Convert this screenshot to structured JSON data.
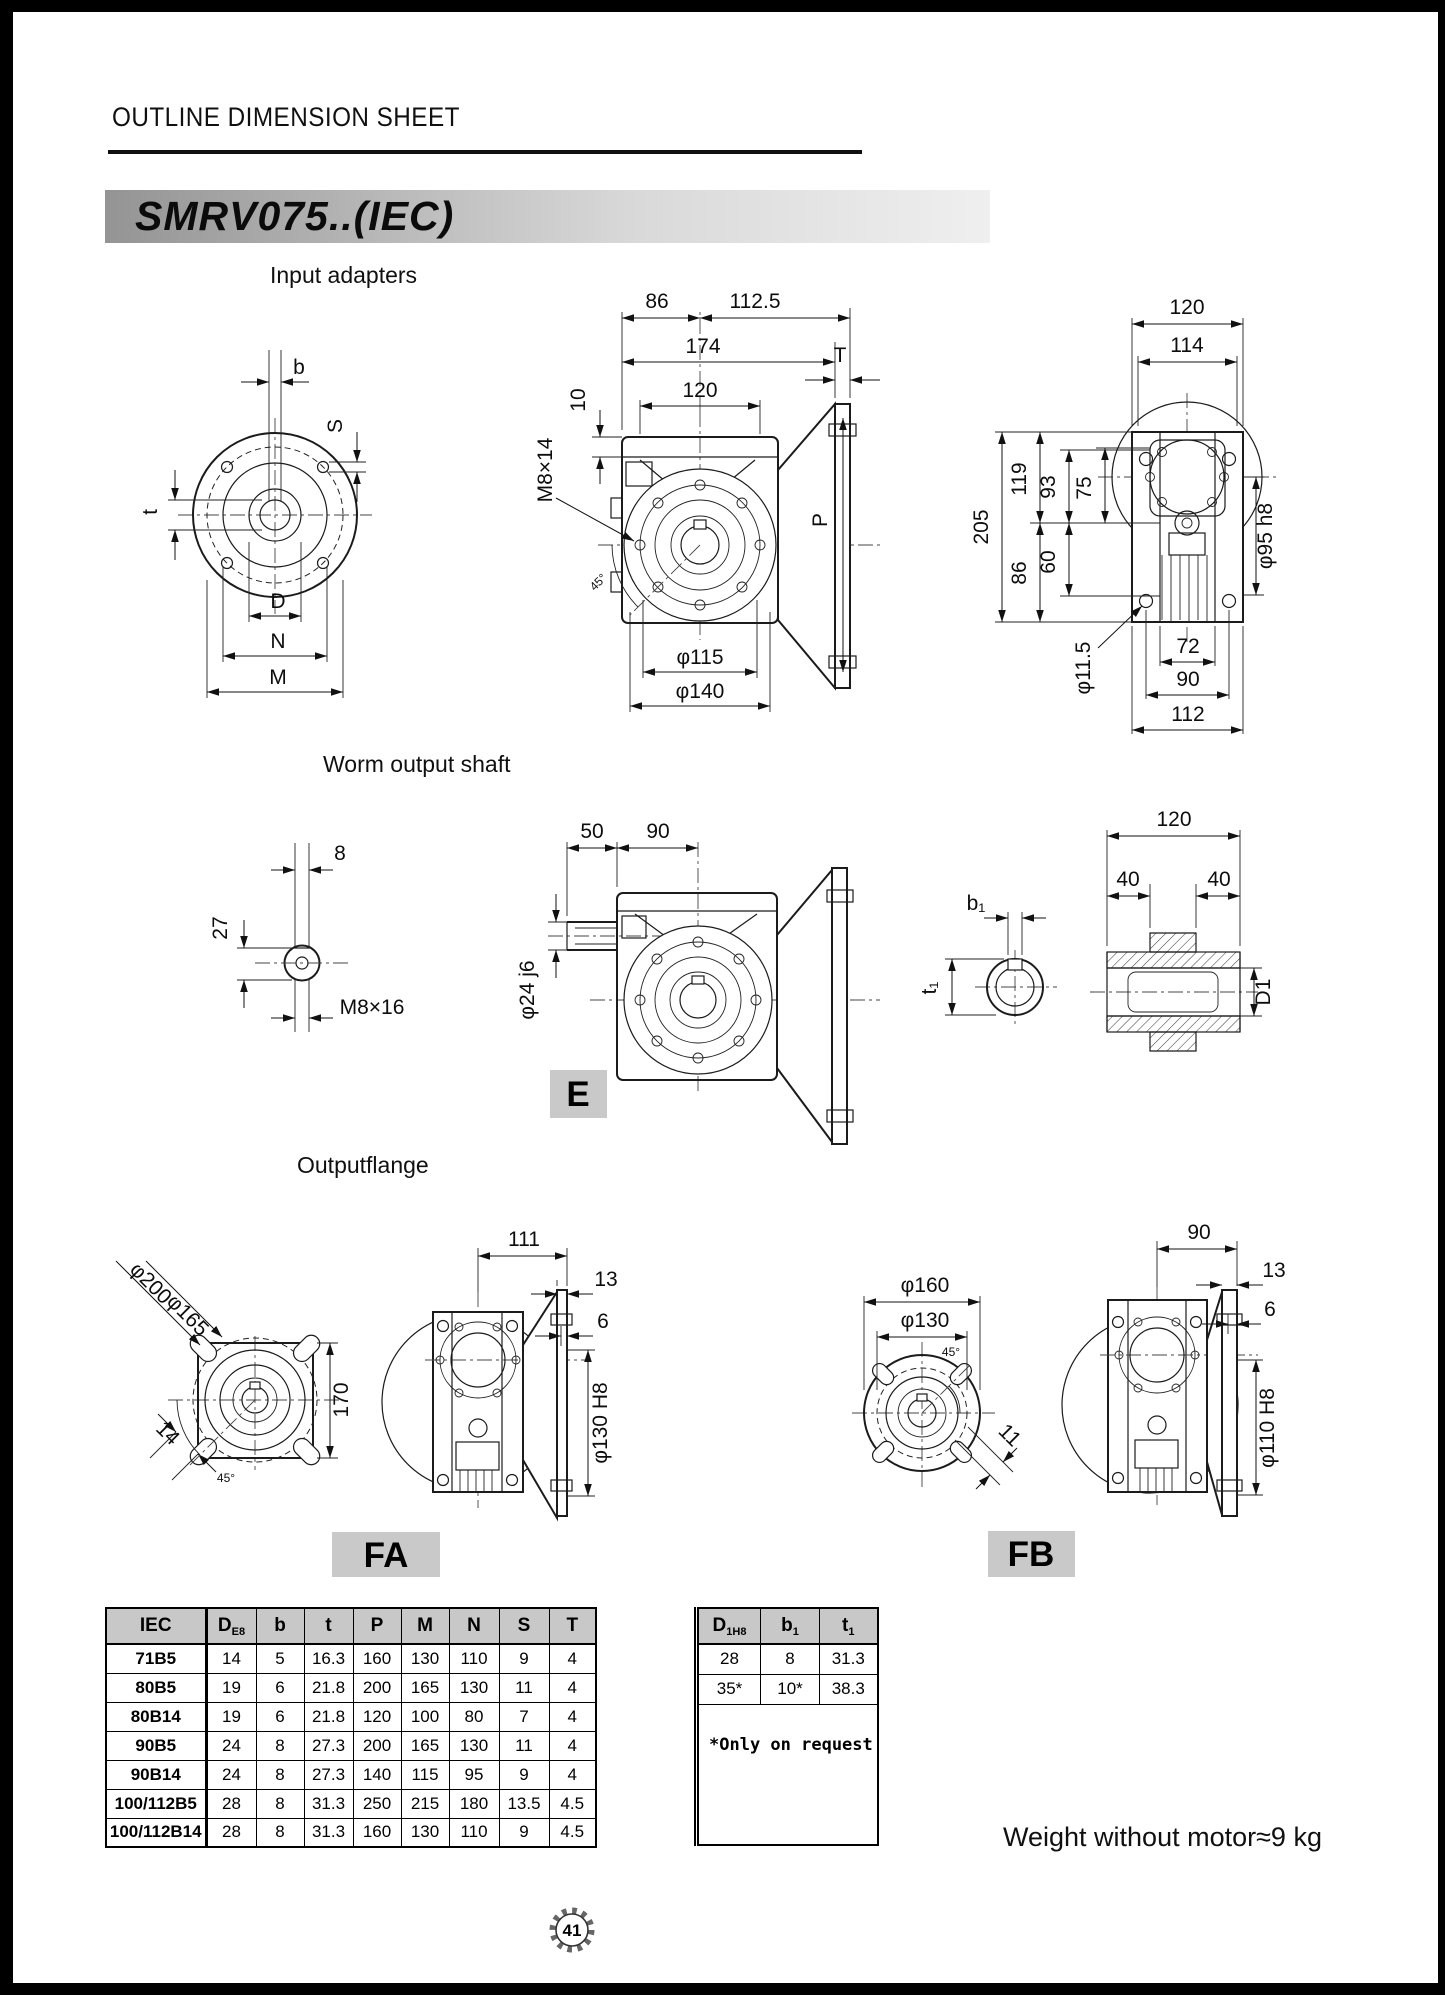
{
  "page": {
    "header": "OUTLINE DIMENSION SHEET",
    "model": "SMRV075..(IEC)",
    "page_number": "41",
    "weight_note": "Weight without motor≈9 kg"
  },
  "sections": {
    "input_adapters": "Input adapters",
    "worm_output_shaft": "Worm output shaft",
    "output_flange": "Outputflange"
  },
  "labels": {
    "e_tag": "E",
    "fa_tag": "FA",
    "fb_tag": "FB"
  },
  "colors": {
    "banner_gray": "#949494",
    "tag_gray": "#c9c9c9",
    "table_header_gray": "#c8c8c8"
  },
  "dims": {
    "ia_front": {
      "b": "b",
      "s": "S",
      "t": "t",
      "d": "D",
      "n": "N",
      "m": "M"
    },
    "ia_side": {
      "w86": "86",
      "w112": "112.5",
      "w174": "174",
      "w120": "120",
      "h10": "10",
      "thread": "M8×14",
      "t": "T",
      "p": "P",
      "d115": "φ115",
      "d140": "φ140",
      "a45": "45°"
    },
    "ia_rear": {
      "w120": "120",
      "w114": "114",
      "h205": "205",
      "h119": "119",
      "h93": "93",
      "h75": "75",
      "h86": "86",
      "h60": "60",
      "d95": "φ95 h8",
      "d11": "φ11.5",
      "w72": "72",
      "w90": "90",
      "w112": "112"
    },
    "ws_end": {
      "w8": "8",
      "h27": "27",
      "thread": "M8×16"
    },
    "ws_side": {
      "w50": "50",
      "w90": "90",
      "d24": "φ24 j6"
    },
    "ws_shaft": {
      "b1": "b₁",
      "t1": "t₁",
      "w120": "120",
      "w40a": "40",
      "w40b": "40",
      "d1": "D1"
    },
    "of_square": {
      "d200": "φ200",
      "d165": "φ165",
      "h170": "170",
      "w14": "14",
      "a45": "45°"
    },
    "of_fa": {
      "w111": "111",
      "w13": "13",
      "w6": "6",
      "d130": "φ130 H8"
    },
    "of_fb_front": {
      "d160": "φ160",
      "d130": "φ130",
      "w11": "11",
      "a45": "45°"
    },
    "of_fb_side": {
      "w90": "90",
      "w13": "13",
      "w6": "6",
      "d110": "φ110 H8"
    }
  },
  "table": {
    "headers": [
      {
        "t": "IEC",
        "s": ""
      },
      {
        "t": "D",
        "s": "E8"
      },
      {
        "t": "b",
        "s": ""
      },
      {
        "t": "t",
        "s": ""
      },
      {
        "t": "P",
        "s": ""
      },
      {
        "t": "M",
        "s": ""
      },
      {
        "t": "N",
        "s": ""
      },
      {
        "t": "S",
        "s": ""
      },
      {
        "t": "T",
        "s": ""
      }
    ],
    "rows": [
      [
        "71B5",
        "14",
        "5",
        "16.3",
        "160",
        "130",
        "110",
        "9",
        "4"
      ],
      [
        "80B5",
        "19",
        "6",
        "21.8",
        "200",
        "165",
        "130",
        "11",
        "4"
      ],
      [
        "80B14",
        "19",
        "6",
        "21.8",
        "120",
        "100",
        "80",
        "7",
        "4"
      ],
      [
        "90B5",
        "24",
        "8",
        "27.3",
        "200",
        "165",
        "130",
        "11",
        "4"
      ],
      [
        "90B14",
        "24",
        "8",
        "27.3",
        "140",
        "115",
        "95",
        "9",
        "4"
      ],
      [
        "100/112B5",
        "28",
        "8",
        "31.3",
        "250",
        "215",
        "180",
        "13.5",
        "4.5"
      ],
      [
        "100/112B14",
        "28",
        "8",
        "31.3",
        "160",
        "130",
        "110",
        "9",
        "4.5"
      ]
    ],
    "extra_headers": [
      {
        "t": "D",
        "s": "1H8"
      },
      {
        "t": "b",
        "s": "1"
      },
      {
        "t": "t",
        "s": "1"
      }
    ],
    "extra_rows": [
      [
        "28",
        "8",
        "31.3"
      ],
      [
        "35*",
        "10*",
        "38.3"
      ]
    ],
    "note": "*Only on request"
  }
}
